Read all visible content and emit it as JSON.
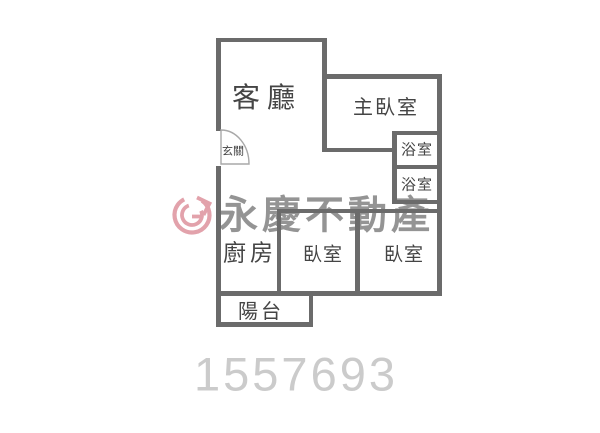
{
  "floorplan": {
    "labels": {
      "living_room": "客廳",
      "master_bedroom": "主臥室",
      "bathroom_upper": "浴室",
      "bathroom_lower": "浴室",
      "kitchen": "廚房",
      "bedroom_left": "臥室",
      "bedroom_right": "臥室",
      "balcony": "陽台",
      "entry": "玄關"
    },
    "wall_color_hex": "#6b6b6b",
    "label_color_hex": "#454545"
  },
  "watermark": {
    "brand_text": "永慶不動產",
    "brand_text_color_hex": "#828282",
    "logo_icon": "yungching-circle-arrow-logo",
    "logo_color_hex": "#dc8b97"
  },
  "listing_id": "1557693",
  "listing_id_color_hex": "#cbcbcb"
}
